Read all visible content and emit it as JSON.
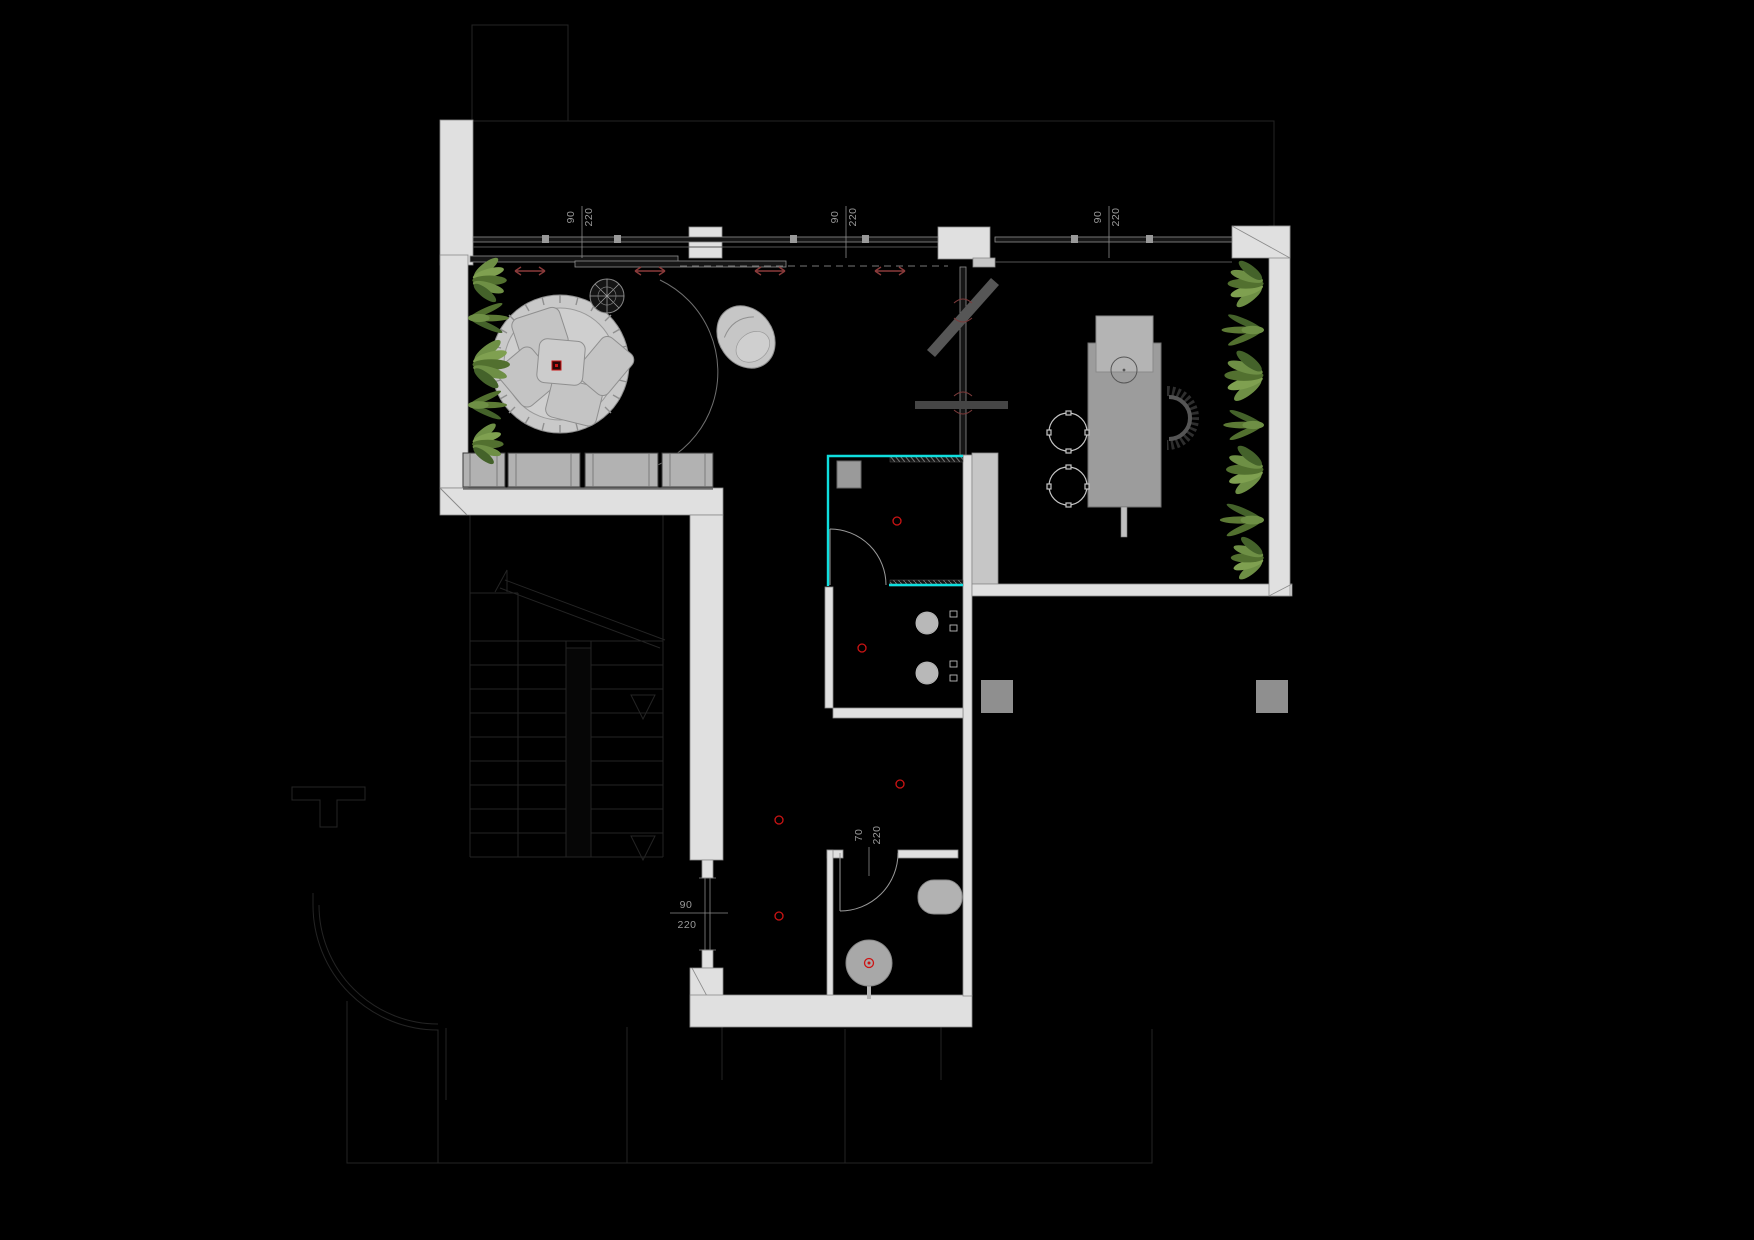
{
  "meta": {
    "drawing_type": "architectural floor plan",
    "theme": "dark CAD plan on black background"
  },
  "colors": {
    "background": "#000000",
    "wall": "#e0e0e0",
    "wall_dark": "#c6c6c6",
    "highlight_cyan": "#0fdede",
    "marker_red": "#cc1414",
    "arrow_red": "#8a3a3a",
    "dim_text": "#9a9a9a",
    "plant_green": "#6e8f45",
    "plant_green_dark": "#52702f",
    "furniture_gray": "#c2c2c2",
    "table_gray": "#9c9c9c"
  },
  "dims": {
    "top": [
      {
        "w": "90",
        "h": "220"
      },
      {
        "w": "90",
        "h": "220"
      },
      {
        "w": "90",
        "h": "220"
      }
    ],
    "corridor_door": {
      "w": "90",
      "h": "220"
    },
    "wc_door": {
      "w": "70",
      "h": "220"
    }
  },
  "markers": {
    "ceiling_point_count": 5,
    "slide_arrow_count": 4
  }
}
